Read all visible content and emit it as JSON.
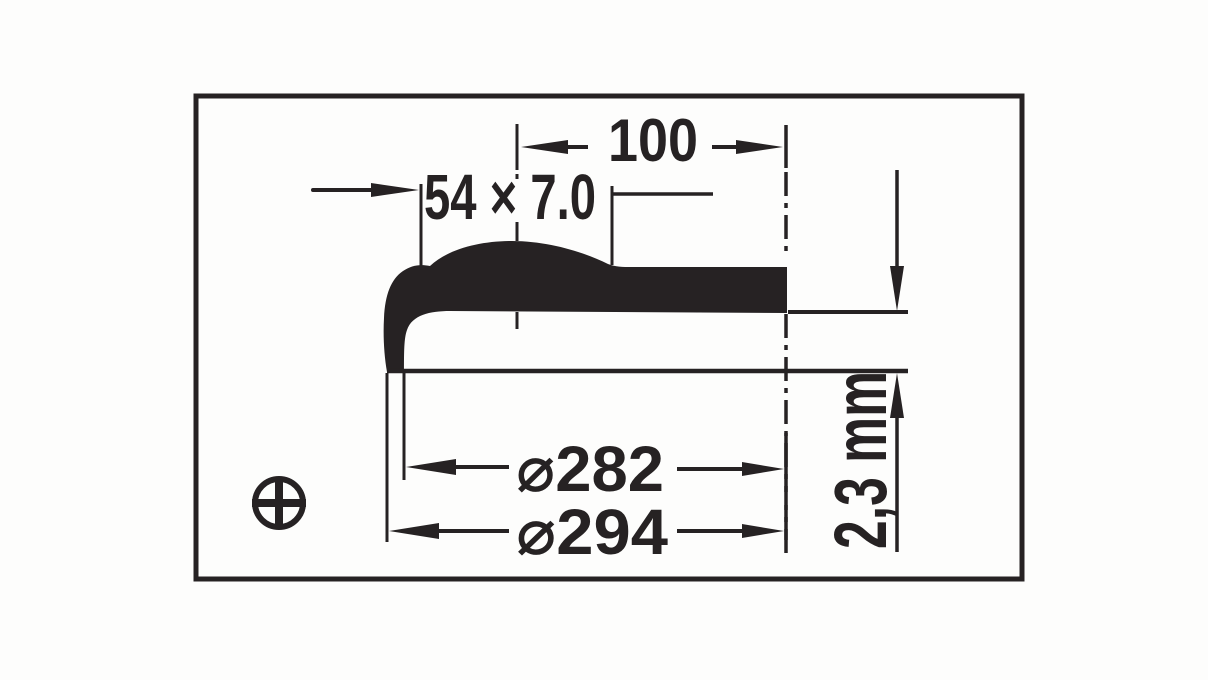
{
  "drawing": {
    "labels": {
      "hump_dimension": "54 × 7.0",
      "width_dimension": "100",
      "diameter_inner": "⌀282",
      "diameter_outer": "⌀294",
      "depth_dimension": "2,3 mm"
    },
    "symbols": {
      "projection_symbol": "circle-cross-icon"
    },
    "colors": {
      "ink": "#262223",
      "paper": "#fdfdfc"
    }
  }
}
